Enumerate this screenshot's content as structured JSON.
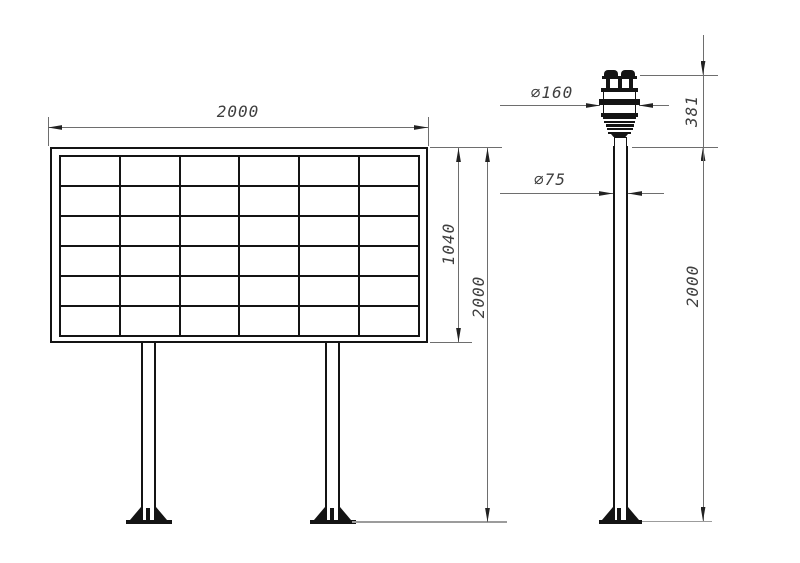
{
  "drawing": {
    "board_view": {
      "grid_columns": 6,
      "grid_rows": 6,
      "dims": {
        "width": "2000",
        "panel_height": "1040",
        "total_height": "2000"
      }
    },
    "sensor_view": {
      "dims": {
        "head_diameter": "∅160",
        "pole_diameter": "∅75",
        "head_height": "381",
        "pole_height": "2000"
      }
    },
    "colors": {
      "object_line": "#141414",
      "dimension_line": "#6e6e6e",
      "ground_line": "#9c9c9c",
      "text": "#3f3f3f",
      "background": "#ffffff"
    }
  }
}
